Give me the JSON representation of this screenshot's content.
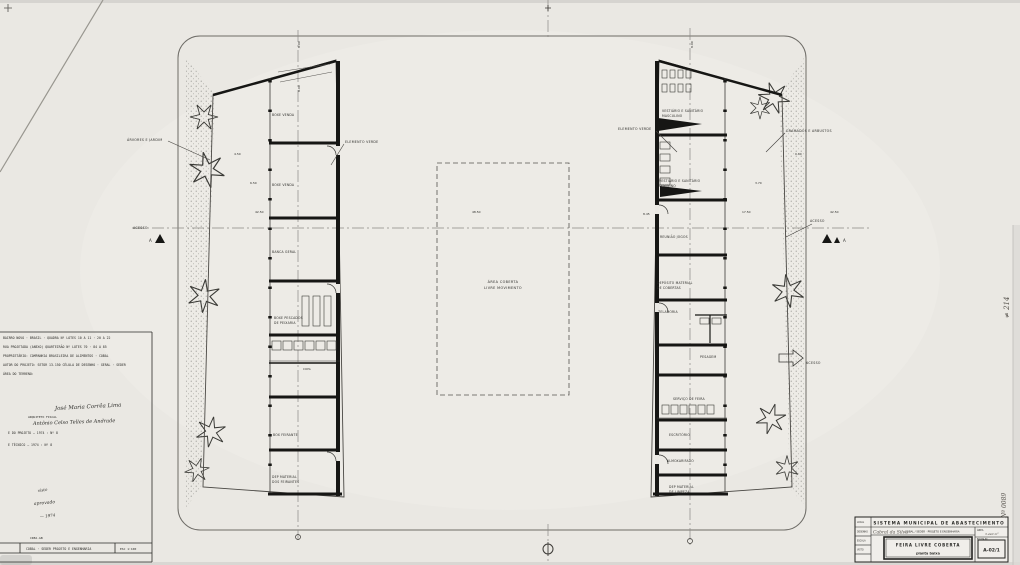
{
  "drawing": {
    "center_area": {
      "line1": "ÁREA COBERTA",
      "line2": "LIVRE MOVIMENTO"
    },
    "leaders": {
      "left_planting": "ÁRVORES E JARDIM",
      "left_green": "ELEMENTO VERDE",
      "right_green": "ELEMENTO VERDE",
      "right_planting": "GRAMADOS E ARBUSTOS",
      "access_left": "ACESSO",
      "access_right": "ACESSO",
      "access_bottom": "ACESSO",
      "section_letter_left": "A",
      "section_letter_right": "A"
    },
    "left_rooms": [
      "BOXE VENDA",
      "BOXE VENDA",
      "BANCA GERAL",
      "BOXE PESCADOS",
      "DE PEIXARIA",
      "COPA",
      "BOX FEIRANTE",
      "DEP MATERIAL",
      "DOS FEIRANTES"
    ],
    "right_rooms": [
      "VESTIÁRIO E SANITÁRIO",
      "MASCULINO",
      "VESTIÁRIO E SANITÁRIO",
      "FEMININO",
      "REUNIÃO JOGOS",
      "DEPÓSITO MATERIAL",
      "DE COBERTAS",
      "ZELADORIA",
      "PESAGEM",
      "SERVIÇO DE FEIRA",
      "ESCRITÓRIO",
      "ALMOXARIFADO",
      "DEP MATERIAL",
      "DE LIMPEZA"
    ],
    "dims": [
      "8.00",
      "8.00",
      "4.50",
      "6.50",
      "42.50",
      "48.50",
      "8.00",
      "8.45",
      "3.70",
      "0.90",
      "17.50",
      "42.50"
    ]
  },
  "info_block": {
    "typed_lines": [
      "BAIRRO NOVO · BRASIL · QUADRA Nº LOTES 10 A 11 · 20 A 22",
      "RUA PROJETADA (ANEXO) QUARTEIRÃO Nº LOTES 70 · 84 A 85",
      "PROPRIETÁRIO: COMPANHIA BRASILEIRA DE ALIMENTOS · COBAL",
      "AUTOR DO PROJETO: SETOR 13.150 CÉLULA DE DESENHO · GERAL · SEDER",
      "ÁREA DO TERRENO:"
    ],
    "arch_label": "ARQUITETO FISCAL",
    "sign1": "José Maria Corrêa Lima",
    "sign2": "Antônio Celso Telles de Andrade",
    "reg1": "E DO PROJETO  —  1974   :   Nº 8",
    "reg2": "E TÉCNICO     —  1974   :   Nº 8",
    "approval1": "visto",
    "approval2": "aprovado",
    "approval3": "— 1974",
    "crea": "CREA-GB",
    "footer": "COBAL · SEDER PROJETO E ENGENHARIA",
    "footer_scale": "ESC 1:100"
  },
  "title_block": {
    "title": "SISTEMA MUNICIPAL DE ABASTECIMENTO",
    "local_value": "Cabral da Silva",
    "org": "COBAL / SEDER · PROJETO E ENGENHARIA",
    "area_label": "ÁREA",
    "area_value": "3.440 m²",
    "sheet_label": "FOLHA Nº",
    "doc_title": "FEIRA LIVRE COBERTA",
    "doc_subtitle": "planta baixa",
    "sheet_number": "A-02/1",
    "side_labels": [
      "LOCAL",
      "DESENHO",
      "ESCALA",
      "VISTO"
    ]
  },
  "margin_notes": {
    "mid": "≠ 214",
    "bottom": "Nº 0089"
  }
}
